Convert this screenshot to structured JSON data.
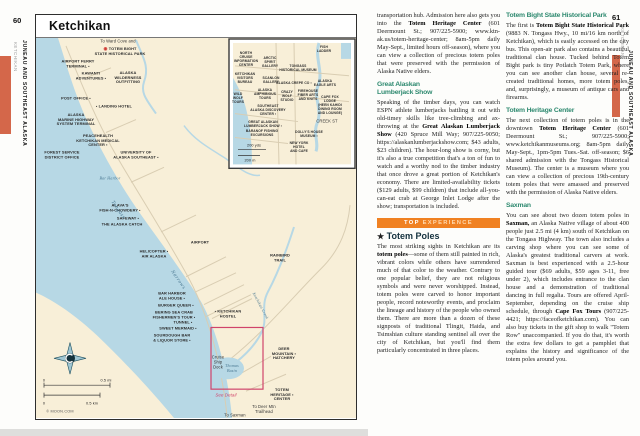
{
  "colors": {
    "tab_orange": "#d4674a",
    "banner_orange": "#f08122",
    "heading_green": "#2f8a70",
    "ocean": "#b7d8e5",
    "land": "#f8efd8",
    "road": "#d9cdb2",
    "detail_red": "#d0446b",
    "water_label": "#46758f"
  },
  "left_page": {
    "page_number": "60",
    "sidebar": {
      "chapter": "JUNEAU AND SOUTHEAST ALASKA",
      "section": "KETCHIKAN"
    },
    "map": {
      "title": "Ketchikan",
      "labels": [
        {
          "t": "To Ward Cove and",
          "x": 82,
          "y": 4,
          "cls": "plain",
          "n": "to-ward-cove-label"
        },
        {
          "t": "TOTEM BIGHT\nSTATE HISTORICAL PARK",
          "x": 84,
          "y": 13,
          "cls": "reddot",
          "n": "totem-bight-label"
        },
        {
          "t": "AIRPORT FERRY\nTERMINAL ▪",
          "x": 42,
          "y": 26
        },
        {
          "t": "KAWANTI\nADVENTURES ▪",
          "x": 55,
          "y": 38
        },
        {
          "t": "ALASKA\nWILDERNESS\nOUTFITTING",
          "x": 92,
          "y": 40
        },
        {
          "t": "POST OFFICE ▪",
          "x": 40,
          "y": 61
        },
        {
          "t": "▪ LANDING HOTEL",
          "x": 78,
          "y": 69
        },
        {
          "t": "ALASKA\nMARINE HIGHWAY\nSYSTEM TERMINAL",
          "x": 40,
          "y": 82
        },
        {
          "t": "PEACEHEALTH\nKETCHIKAN MEDICAL\nCENTER ▪",
          "x": 62,
          "y": 103
        },
        {
          "t": "FOREST SERVICE\nDISTRICT OFFICE",
          "x": 26,
          "y": 117
        },
        {
          "t": "UNIVERSITY OF\nALASKA SOUTHEAST ▪",
          "x": 100,
          "y": 117
        },
        {
          "t": "ALAVA'S\nFISH-N-CHOWDERY ▪",
          "x": 84,
          "y": 170
        },
        {
          "t": "SAFEWAY ▪",
          "x": 92,
          "y": 181
        },
        {
          "t": "THE ALASKA CATCH",
          "x": 86,
          "y": 187
        },
        {
          "t": "HELICOPTER ▪\nAIR ALASKA",
          "x": 118,
          "y": 216
        },
        {
          "t": "AIRPORT",
          "x": 164,
          "y": 205
        },
        {
          "t": "RAINBIRD\nTRAIL",
          "x": 244,
          "y": 220
        },
        {
          "t": "BAR HARBOR\nALE HOUSE ▪",
          "x": 136,
          "y": 258
        },
        {
          "t": "BURGER QUEEN ▪",
          "x": 140,
          "y": 268
        },
        {
          "t": "BERING SEA CRAB\nFISHERMEN'S TOUR ▪",
          "x": 138,
          "y": 277
        },
        {
          "t": "TUNNEL ▪",
          "x": 147,
          "y": 285
        },
        {
          "t": "SWEET MERMAID ▪",
          "x": 142,
          "y": 291
        },
        {
          "t": "SOURDOUGH BAR\n& LIQUOR STORE ▪",
          "x": 136,
          "y": 300
        },
        {
          "t": "▪ KETCHIKAN\nHOSTEL",
          "x": 192,
          "y": 276
        },
        {
          "t": "DEER\nMOUNTAIN ▪\nHATCHERY",
          "x": 248,
          "y": 316
        },
        {
          "t": "TOTEM\nHERITAGE ▪\nCENTER",
          "x": 246,
          "y": 357
        },
        {
          "t": "Cruise\nShip\nDock",
          "x": 182,
          "y": 325,
          "cls": "plain",
          "n": "cruise-ship-dock-label"
        },
        {
          "t": "See Detail",
          "x": 190,
          "y": 357,
          "cls": "red",
          "n": "see-detail-label"
        },
        {
          "t": "To Saxman",
          "x": 199,
          "y": 378,
          "cls": "plain",
          "n": "to-saxman-label"
        },
        {
          "t": "To Deer Mtn\nTrailhead",
          "x": 228,
          "y": 372,
          "cls": "plain",
          "n": "to-deer-mtn-label"
        },
        {
          "t": "Tongass",
          "x": 82,
          "y": 172,
          "cls": "water",
          "rot": 55,
          "n": "tongass-narrows-label"
        },
        {
          "t": "Narrows",
          "x": 142,
          "y": 242,
          "cls": "water",
          "rot": 55,
          "n": "tongass-narrows-label"
        },
        {
          "t": "Bar Harbor",
          "x": 74,
          "y": 141,
          "cls": "water sm2"
        },
        {
          "t": "Thomas\nBasin",
          "x": 196,
          "y": 331,
          "cls": "water sm2"
        },
        {
          "t": "Ketchikan Creek",
          "x": 224,
          "y": 268,
          "cls": "water sm2",
          "rot": 62
        },
        {
          "t": "0",
          "x": 8,
          "y": 343,
          "cls": "scale"
        },
        {
          "t": "0.5 mi",
          "x": 70,
          "y": 343,
          "cls": "scale"
        },
        {
          "t": "0",
          "x": 8,
          "y": 366,
          "cls": "scale"
        },
        {
          "t": "0.5 km",
          "x": 56,
          "y": 366,
          "cls": "scale"
        },
        {
          "t": "© MOON.COM",
          "x": 24,
          "y": 374,
          "cls": "credit",
          "n": "map-credit"
        },
        {
          "t": "NORTH\nCRUISE\nINFORMATION\nCENTER",
          "x": 210,
          "y": 22,
          "cls": "sm"
        },
        {
          "t": "ARCTIC\nSPIRIT\nGALLERY",
          "x": 234,
          "y": 25,
          "cls": "sm"
        },
        {
          "t": "FISH\nLADDER",
          "x": 288,
          "y": 12,
          "cls": "sm"
        },
        {
          "t": "TONGASS\nHISTORICAL MUSEUM",
          "x": 262,
          "y": 31,
          "cls": "sm"
        },
        {
          "t": "KETCHIKAN\nVISITORS\nBUREAU",
          "x": 209,
          "y": 41,
          "cls": "sm"
        },
        {
          "t": "SCANLON\nGALLERY",
          "x": 235,
          "y": 43,
          "cls": "sm"
        },
        {
          "t": "ALASKA CREPE CO ▪",
          "x": 258,
          "y": 46,
          "cls": "sm"
        },
        {
          "t": "ALASKA\nEAGLE ARTS",
          "x": 289,
          "y": 46,
          "cls": "sm"
        },
        {
          "t": "ALASKA\nAMPHIBIOUS\nTOURS",
          "x": 229,
          "y": 57,
          "cls": "sm"
        },
        {
          "t": "WILD\nWOLF\nTOURS",
          "x": 202,
          "y": 61,
          "cls": "sm"
        },
        {
          "t": "CRAZY\nWOLF\nSTUDIO",
          "x": 251,
          "y": 59,
          "cls": "sm"
        },
        {
          "t": "FIREHOUSE\nFIBER ARTS\nAND KNITS",
          "x": 272,
          "y": 58,
          "cls": "sm"
        },
        {
          "t": "CAPE FOX\nLODGE\n(HEEN KAHIDI\nDINING ROOM\nAND LOUNGE)",
          "x": 294,
          "y": 68,
          "cls": "sm"
        },
        {
          "t": "SOUTHEAST\nALASKA DISCOVERY\nCENTER ▪",
          "x": 232,
          "y": 73,
          "cls": "sm"
        },
        {
          "t": "CREEK ST",
          "x": 291,
          "y": 84,
          "cls": "plain sm"
        },
        {
          "t": "GREAT ALASKAN\nLUMBERJACK SHOW ▪",
          "x": 227,
          "y": 87,
          "cls": "sm"
        },
        {
          "t": "BARANOF FISHING\nEXCURSIONS",
          "x": 226,
          "y": 96,
          "cls": "sm"
        },
        {
          "t": "DOLLY'S HOUSE\nMUSEUM ▪",
          "x": 273,
          "y": 97,
          "cls": "sm"
        },
        {
          "t": "NEW YORK\nHOTEL\nAND CAFE",
          "x": 263,
          "y": 110,
          "cls": "sm"
        },
        {
          "t": "200 yds",
          "x": 218,
          "y": 108,
          "cls": "scale sm"
        },
        {
          "t": "200 m",
          "x": 214,
          "y": 123,
          "cls": "scale sm"
        }
      ]
    }
  },
  "right_page": {
    "page_number": "61",
    "sidebar": {
      "chapter": "JUNEAU AND SOUTHEAST ALASKA",
      "section": "KETCHIKAN"
    },
    "banner": {
      "top": "TOP",
      "rest": "EXPERIENCE"
    },
    "columns": [
      {
        "blocks": [
          {
            "type": "p",
            "text": "transportation hub. Admission here also gets you into the **Totem Heritage Center** (601 Deermount St.; 907/225-5900; www.ktn-ak.us/totem-heritage-center; 8am-5pm daily May-Sept., limited hours off-season), where you can view a collection of precious totem poles that were preserved with the permission of Alaska Native elders."
          },
          {
            "type": "h",
            "text": "Great Alaskan\nLumberjack Show"
          },
          {
            "type": "p",
            "text": "Speaking of the timber days, you can watch ESPN athlete lumberjacks battling it out with old-timey skills like tree-climbing and ax-throwing at the **Great Alaskan Lumberjack Show** (420 Spruce Mill Way; 907/225-9050; https://alaskanlumberjackshow.com; $43 adults, $23 children). The hour-long show is corny, but it's also a true competition that's a ton of fun to watch and a worthy nod to the timber industry that once drove a great portion of Ketchikan's economy. There are limited-availability tickets ($129 adults, $99 children) that include all-you-can-eat crab at George Inlet Lodge after the show; transportation is included."
          },
          {
            "type": "banner"
          },
          {
            "type": "sight",
            "text": "Totem Poles"
          },
          {
            "type": "p",
            "text": "The most striking sights in Ketchikan are its **totem poles**—some of them still painted in rich, vibrant colors while others have surrendered much of that color to the weather. Contrary to one popular belief, they are not religious symbols and were never worshipped. Instead, totem poles were carved to honor important people, record noteworthy events, and proclaim the lineage and history of the people who owned them. There are more than a dozen of these signposts of traditional Tlingit, Haida, and Tsimshian culture standing sentinel all over the city of Ketchikan, but you'll find them particularly concentrated in three places."
          }
        ]
      },
      {
        "blocks": [
          {
            "type": "h",
            "text": "Totem Bight State Historical Park"
          },
          {
            "type": "p",
            "text": "The first is **Totem Bight State Historical Park** (9883 N. Tongass Hwy., 10 mi/16 km north of Ketchikan), which is easily accessed on the city bus. This open-air park also contains a beautiful traditional clan house. Tucked behind Totem Bight park is tiny Potlatch Totem Park, where you can see another clan house, several re-created traditional homes, more totem poles, and, surprisingly, a museum of antique cars and firearms."
          },
          {
            "type": "h",
            "text": "Totem Heritage Center"
          },
          {
            "type": "p",
            "text": "The next collection of totem poles is in the downtown **Totem Heritage Center** (601 Deermount St.; 907/225-5900; www.ketchikanmuseums.org; 8am-5pm daily May-Sept., 1pm-5pm Tues.-Sat. off-season; $6 shared admission with the Tongass Historical Museum). The center is a museum where you can view a collection of precious 19th-century totem poles that were amassed and preserved with the permission of Alaska Native elders."
          },
          {
            "type": "h",
            "text": "Saxman"
          },
          {
            "type": "p",
            "text": "You can see about two dozen totem poles in **Saxman,** an Alaska Native village of about 400 people just 2.5 mi (4 km) south of Ketchikan on the Tongass Highway. The town also includes a carving shop where you can see some of Alaska's greatest traditional carvers at work. Saxman is best experienced with a 2.5-hour guided tour ($69 adults, $59 ages 3-11, free under 2), which includes entrance to the clan house and a demonstration of traditional dancing in full regalia. Tours are offered April-September, depending on the cruise ship schedule, through **Cape Fox Tours** (907/225-4421; https://faceofketchikan.com). You can also buy tickets in the gift shop to walk \"Totem Row\" unaccompanied. If you do that, it's worth the extra few dollars to get a pamphlet that explains the history and significance of the totem poles around you."
          }
        ]
      }
    ]
  }
}
